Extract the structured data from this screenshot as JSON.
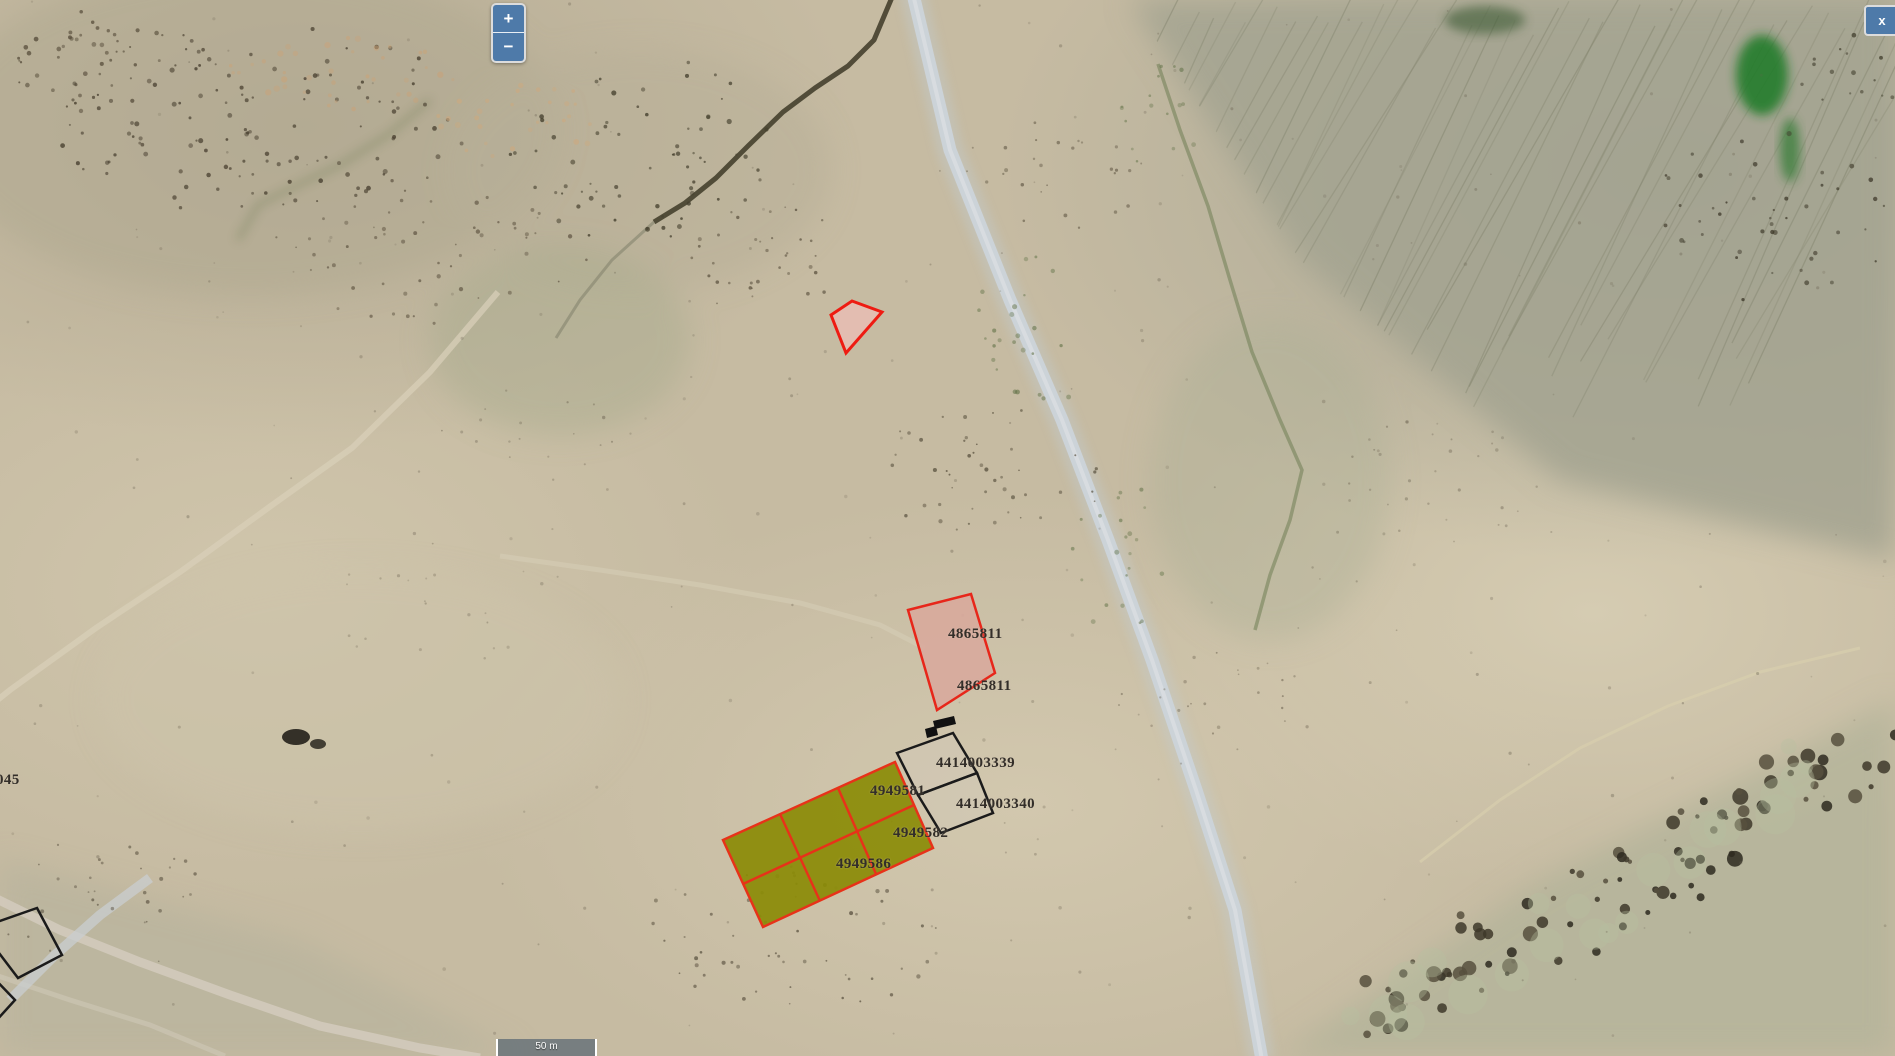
{
  "controls": {
    "zoom_in": "+",
    "zoom_out": "−",
    "overlay_close": "x",
    "scale_text": "50 m"
  },
  "parcel_labels": {
    "pink_top": "4865811",
    "pink_bottom": "4865811",
    "black_top": "4414003339",
    "black_bottom": "4414003340",
    "olive_top": "4949581",
    "olive_mid": "4949582",
    "olive_bottom": "4949586",
    "edge_partial": "045"
  },
  "colors": {
    "control_blue": "#4e7aa9",
    "parcel_red_stroke": "#e7261a",
    "parcel_pink_fill": "#d8a89c",
    "parcel_olive_fill": "#8b8b06",
    "parcel_black_stroke": "#1b1b1b",
    "label_text": "#332e29"
  }
}
